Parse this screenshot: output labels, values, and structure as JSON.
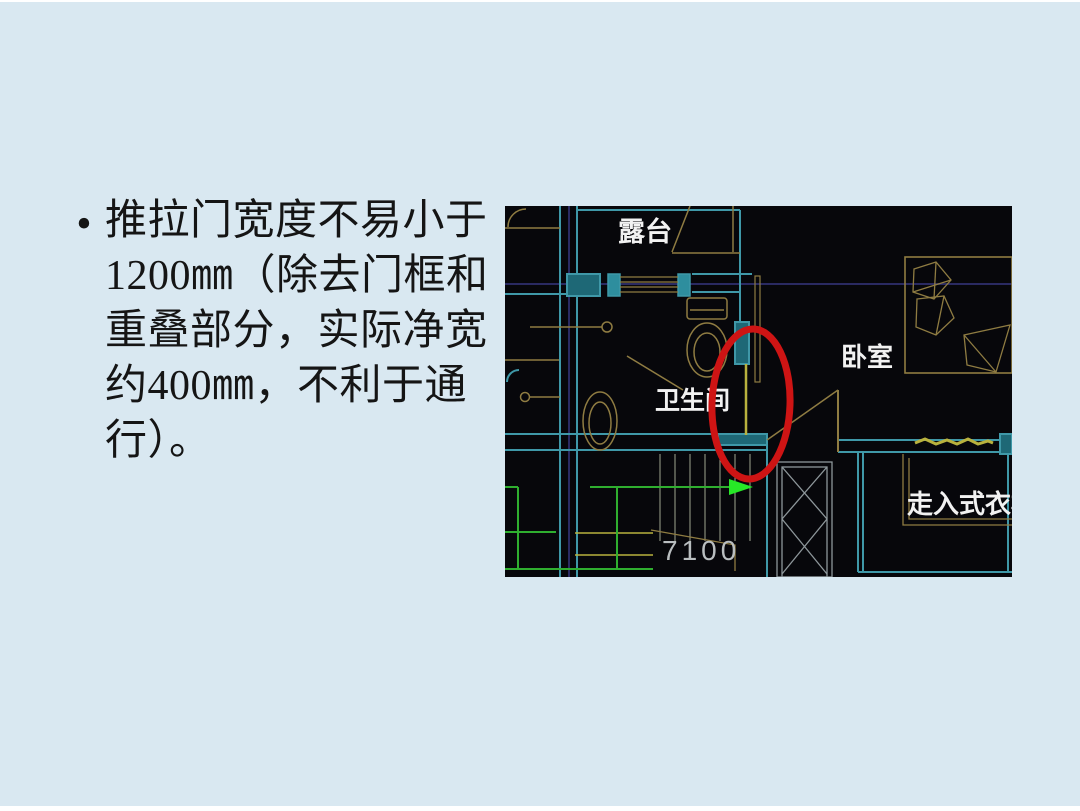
{
  "slide": {
    "background": "#D9E8F1",
    "text_color": "#151515",
    "bullet": {
      "marker": "•",
      "lines": [
        "推拉门宽度不易小于",
        "1200㎜（除去门框和",
        "重叠部分，实际净宽",
        "约400㎜，不利于通",
        "行）。"
      ],
      "full_text": "推拉门宽度不易小于1200㎜（除去门框和重叠部分，实际净宽约400㎜，不利于通行）。"
    }
  },
  "floorplan": {
    "labels": {
      "terrace": "露台",
      "bedroom": "卧室",
      "bathroom": "卫生间",
      "closet": "走入式衣柜",
      "dimension": "7100"
    },
    "annotation": "red-ellipse-highlight-on-sliding-door",
    "colors": {
      "plan-background": "#07070B",
      "wall-cyan": "#3F98A8",
      "wall-fill": "#1E6876",
      "wall-block": "#2E8E9E",
      "fixture-tan": "#8F7C42",
      "door-yellow": "#B9B23E",
      "route-green": "#2FAE2F",
      "arrow-green": "#27E827",
      "grid-navy": "#2A2A62",
      "detail-gray": "#8E979B",
      "stair-olive": "#9FA48F",
      "label-white": "#F2F2F2",
      "dimension-gray": "#B9BEC0",
      "highlight-red": "#CE1414"
    }
  }
}
